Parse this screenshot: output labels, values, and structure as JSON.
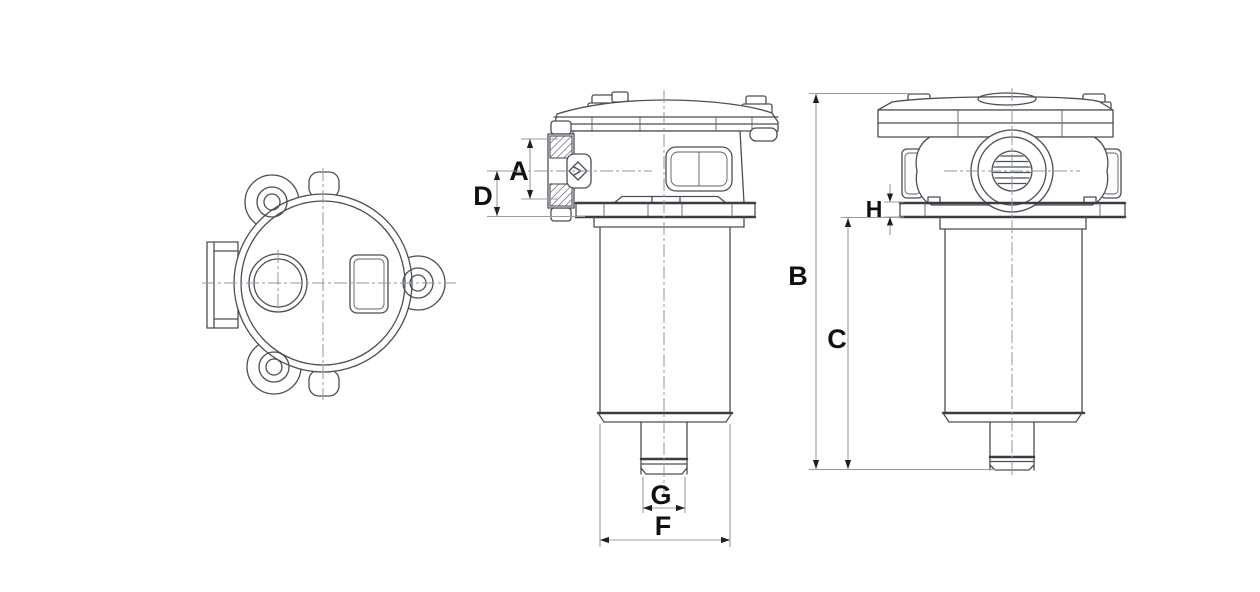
{
  "page": {
    "background_color": "#ffffff"
  },
  "drawing": {
    "type": "engineering-dimension-drawing",
    "subject": "tank-mounted filter assembly, three orthographic views",
    "views": [
      {
        "name": "top view"
      },
      {
        "name": "side elevation"
      },
      {
        "name": "front elevation"
      }
    ],
    "dimensions": {
      "A": {
        "label": "A"
      },
      "B": {
        "label": "B"
      },
      "C": {
        "label": "C"
      },
      "D": {
        "label": "D"
      },
      "F": {
        "label": "F"
      },
      "G": {
        "label": "G"
      },
      "H": {
        "label": "H"
      }
    },
    "colors": {
      "object_line": "#4a4f55",
      "thick_line": "#383d43",
      "dimension_line": "#979da4",
      "centerline": "#9098a0",
      "label": "#0e1013",
      "background": "#ffffff"
    }
  }
}
